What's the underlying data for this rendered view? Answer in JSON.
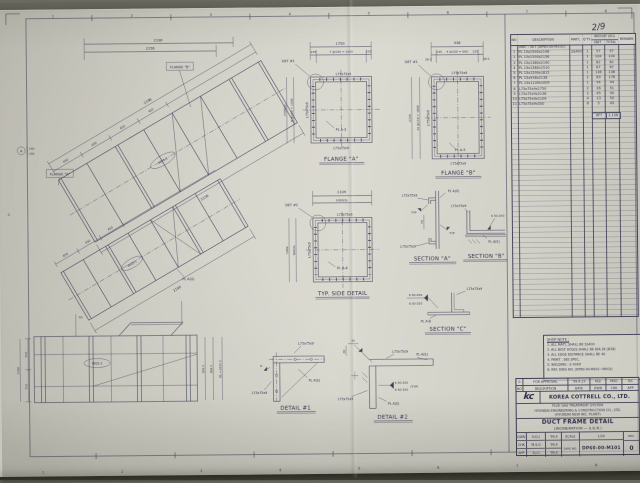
{
  "sheet": {
    "page_marker": "2/9",
    "grid_top": [
      "1",
      "2",
      "3",
      "4",
      "5",
      "6",
      "7",
      "8"
    ],
    "grid_bottom": [
      "1",
      "2",
      "3",
      "4",
      "5",
      "6",
      "7",
      "8"
    ],
    "grid_left": "C",
    "mark": "A",
    "mark_d1": "150",
    "mark_d2": "150"
  },
  "views": {
    "elev1": {
      "flange_a_callout": "FLANGE \"A\"",
      "flange_b_callout": "FLANGE \"B\"",
      "tag": "W01-1",
      "dim_h1": "2196",
      "dim_h2": "2156",
      "dim_axis": "2196",
      "dim_below": "2156",
      "seg": "450"
    },
    "elev2": {
      "tag": "W03-1",
      "plate": "PL A(S)",
      "dim_below": "2190",
      "seg": "450"
    },
    "elev3": {
      "tag": "W02-1",
      "left1": "750",
      "left2": "750",
      "left_total": "1500",
      "stub": "50",
      "right1": "950.5",
      "right2": "902.5",
      "right3": "EL.+1635.5"
    },
    "flange_a": {
      "title": "FLANGE \"A\"",
      "det": "DET #1",
      "dim_total": "1750",
      "dim_chain": "7 @150 = 1050",
      "dim_end": "135",
      "left_chain": "8 @150 = 1200",
      "left_total": "1500(S)",
      "angle": "L75x75x9",
      "plate": "PL A-3"
    },
    "flange_b": {
      "title": "FLANGE \"B\"",
      "det": "DET #1",
      "dim_total": "938",
      "dim_chain": "4 @150 = 600",
      "dim_end": "135",
      "dim_corner": "28.5",
      "left_chain": "12 @150 = 1800",
      "left_total": "2136",
      "angle": "L75x75x9",
      "plate": "PL A-5"
    },
    "typ_side": {
      "title": "TYP. SIDE DETAIL",
      "det": "DET #2",
      "dim_total": "1109",
      "dim_chain": "1000(S)",
      "left_chain": "900(S)",
      "left_total": "1009",
      "angle": "L75x75x9",
      "plate": "PL A-6"
    },
    "section_a": {
      "title": "SECTION \"A\"",
      "angle": "L75x75x9",
      "plate": "PL A(S)",
      "weld": "TYP",
      "dim": "50"
    },
    "section_b": {
      "title": "SECTION \"B\"",
      "angle": "L75x75x9",
      "weld": "6 50-250",
      "plate": "PL A(S)"
    },
    "section_c": {
      "title": "SECTION \"C\"",
      "weld": "6 50-250",
      "angle": "L75x75x9",
      "plate": "PL A-B"
    },
    "detail_1": {
      "title": "DETAIL #1",
      "angle": "L75x75x9",
      "plate": "PL A(S)",
      "weld": "6"
    },
    "detail_2": {
      "title": "DETAIL #2",
      "angle": "L75x75x9",
      "plate": "PL A(S)",
      "weld": "6 50-250",
      "weld_typ": "(TYP)",
      "dim": "30"
    }
  },
  "bom": {
    "cols": {
      "no": "NO",
      "desc": "DESCRIPTION",
      "matl": "MAT'L",
      "qty": "Q'TY",
      "weight": "WEIGHT (KG)",
      "unit": "UNIT",
      "total": "TOTAL",
      "remark": "REMARK"
    },
    "unit_note": "UNIT : SET (DP60-00-M101)",
    "rows": [
      {
        "no": "1",
        "desc": "PL 15x1500x2196",
        "matl": "SS400",
        "qty": "1",
        "unit": "57",
        "total": "57"
      },
      {
        "no": "2",
        "desc": "PL 15x1500x2156",
        "matl": "",
        "qty": "1",
        "unit": "104",
        "total": "104"
      },
      {
        "no": "3",
        "desc": "PL 15x1380x2190",
        "matl": "",
        "qty": "1",
        "unit": "82",
        "total": "82"
      },
      {
        "no": "4",
        "desc": "PL 15x1380x1510",
        "matl": "",
        "qty": "1",
        "unit": "67",
        "total": "67"
      },
      {
        "no": "5",
        "desc": "PL 15x1500x1815",
        "matl": "",
        "qty": "1",
        "unit": "136",
        "total": "136"
      },
      {
        "no": "6",
        "desc": "PL 15x938x2136",
        "matl": "",
        "qty": "2",
        "unit": "89",
        "total": "178"
      },
      {
        "no": "7",
        "desc": "PL 15x1109x1009",
        "matl": "",
        "qty": "1",
        "unit": "94",
        "total": "94"
      },
      {
        "no": "8",
        "desc": "L75x75x9x1750",
        "matl": "",
        "qty": "2",
        "unit": "26",
        "total": "51"
      },
      {
        "no": "9",
        "desc": "L75x75x9x2136",
        "matl": "",
        "qty": "2",
        "unit": "45",
        "total": "90"
      },
      {
        "no": "10",
        "desc": "L75x75x9x1109",
        "matl": "",
        "qty": "4",
        "unit": "13",
        "total": "50"
      },
      {
        "no": "11",
        "desc": "L75x75x9x500",
        "matl": "",
        "qty": "8",
        "unit": "5",
        "total": "43"
      }
    ],
    "total_label": "W'T",
    "total_value": "1,138"
  },
  "shop_note": {
    "title": "SHOP NOTE :",
    "items": [
      "1. ALL MAT'L SHALL BE SS400",
      "2. ALL BOLT HOLES SHALL BE DIA.18 (Ø18)",
      "3. ALL EDGE DISTANCE SHALL BE 40",
      "4. PAINT : SEE SPEC.",
      "5. WELDING : E 43XX",
      "6. REF. DWG NO. (DP60-00-M001~M003)"
    ]
  },
  "title_block": {
    "approval": {
      "mark": "0",
      "label": "FOR APPROVAL",
      "date": "'99.4.23",
      "s1": "KDJ",
      "s2": "MSG",
      "s3": "SJC"
    },
    "cols": {
      "no": "NO",
      "desc": "DESCRIPTION",
      "date": "DATE",
      "dwn": "DWN",
      "chk": "CHK",
      "app": "APP"
    },
    "company": {
      "logo": "kc",
      "name": "KOREA COTTRELL CO., LTD."
    },
    "project1": "FLUE GAS TREATMENT SYSTEM",
    "project2": "HYUNDAI ENGINEERING & CONSTRUCTION CO., LTD.",
    "project3": "(HYUNDAI NEW INC. PLANT)",
    "title": "DUCT FRAME DETAIL",
    "subtitle": "(INCINERATION — S.D.R.)",
    "sign": {
      "r1l": "DWN",
      "r1n": "K.D.J",
      "r1d": "'99.4",
      "r2l": "CHK",
      "r2n": "M.S.G",
      "r2d": "'99.4",
      "r3l": "APP",
      "r3n": "S.J.C",
      "r3d": "'99.4"
    },
    "scale_label": "SCALE",
    "scale": "1/20",
    "dwg_label": "DWG NO.",
    "dwg_no": "DP60-00-M101",
    "rev_label": "REV.",
    "rev": "0"
  }
}
